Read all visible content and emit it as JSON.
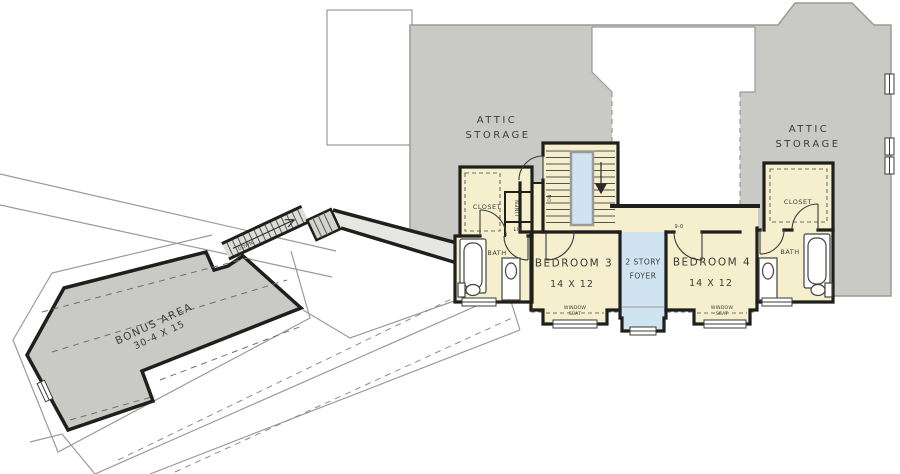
{
  "rooms": {
    "attic_left": {
      "l1": "ATTIC",
      "l2": "STORAGE"
    },
    "attic_right": {
      "l1": "ATTIC",
      "l2": "STORAGE"
    },
    "bonus": {
      "name": "BONUS AREA",
      "dims": "30-4 X 15"
    },
    "bedroom3": {
      "name": "BEDROOM 3",
      "dims": "14 X 12"
    },
    "bedroom4": {
      "name": "BEDROOM 4",
      "dims": "14 X 12"
    },
    "foyer": {
      "l1": "2 STORY",
      "l2": "FOYER"
    },
    "closet_left": {
      "label": "CLOSET"
    },
    "closet_right": {
      "label": "CLOSET"
    },
    "bath_left": {
      "label": "BATH"
    },
    "bath_right": {
      "label": "BATH"
    },
    "linen": {
      "label": "LINEN"
    },
    "lin": {
      "label": "LIN"
    },
    "window_seat_left": {
      "l1": "WINDOW",
      "l2": "SEAT"
    },
    "window_seat_right": {
      "l1": "WINDOW",
      "l2": "SEAT"
    }
  },
  "annotations": {
    "door_dim": "9-0",
    "stairs_dn": "DN",
    "bonus_stairs_dn": "DOWN"
  },
  "colors": {
    "attic_gray": "#c9c9c5",
    "room_cream": "#f6efce",
    "open_below_blue": "#cfe3f0",
    "wall_black": "#1f1f1d",
    "thin_line": "#9a9a96",
    "text": "#3b3b39"
  }
}
